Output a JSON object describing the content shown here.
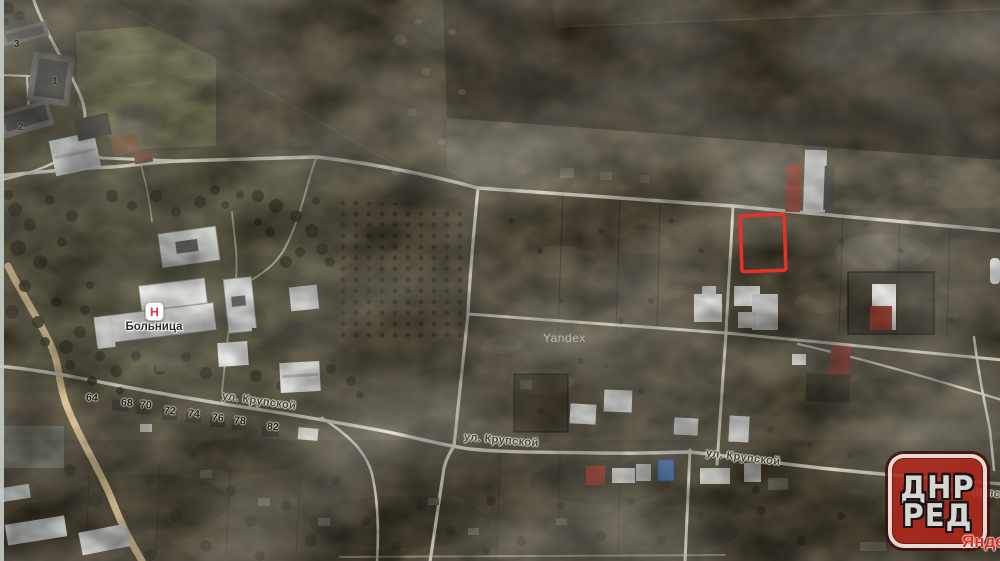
{
  "colors": {
    "terrain": "#59523f",
    "field_dark": "#463e2f",
    "road": "#d7d3c5",
    "road_yellow": "#e0c795",
    "plot_highlight": "#e63128",
    "logo_red": "#b3271d",
    "hospital_red": "#e03345",
    "brand_red": "#df2b1e"
  },
  "hospital": {
    "name": "Больница",
    "icon_letter": "Н"
  },
  "watermark": {
    "text": "Yandex"
  },
  "brand": {
    "partial_text": "Яндекс"
  },
  "logo": {
    "line1": "ДНР",
    "line2": "РЕД"
  },
  "street_labels": [
    {
      "text": "ул. Крупской",
      "x": 222,
      "y": 390,
      "angle": 8
    },
    {
      "text": "ул. Крупской",
      "x": 464,
      "y": 431,
      "angle": 5
    },
    {
      "text": "ул. Крупской",
      "x": 706,
      "y": 447,
      "angle": 7
    },
    {
      "text": "ул. Крупской",
      "x": 946,
      "y": 481,
      "angle": 8
    }
  ],
  "house_numbers": [
    {
      "text": "64",
      "x": 86,
      "y": 392
    },
    {
      "text": "68",
      "x": 121,
      "y": 397
    },
    {
      "text": "70",
      "x": 140,
      "y": 399
    },
    {
      "text": "72",
      "x": 164,
      "y": 405
    },
    {
      "text": "74",
      "x": 188,
      "y": 408
    },
    {
      "text": "76",
      "x": 212,
      "y": 412
    },
    {
      "text": "78",
      "x": 234,
      "y": 415
    },
    {
      "text": "82",
      "x": 267,
      "y": 421
    }
  ],
  "building_numbers": [
    {
      "text": "3",
      "x": 14,
      "y": 39
    },
    {
      "text": "1",
      "x": 52,
      "y": 76
    },
    {
      "text": "2",
      "x": 18,
      "y": 122
    }
  ]
}
